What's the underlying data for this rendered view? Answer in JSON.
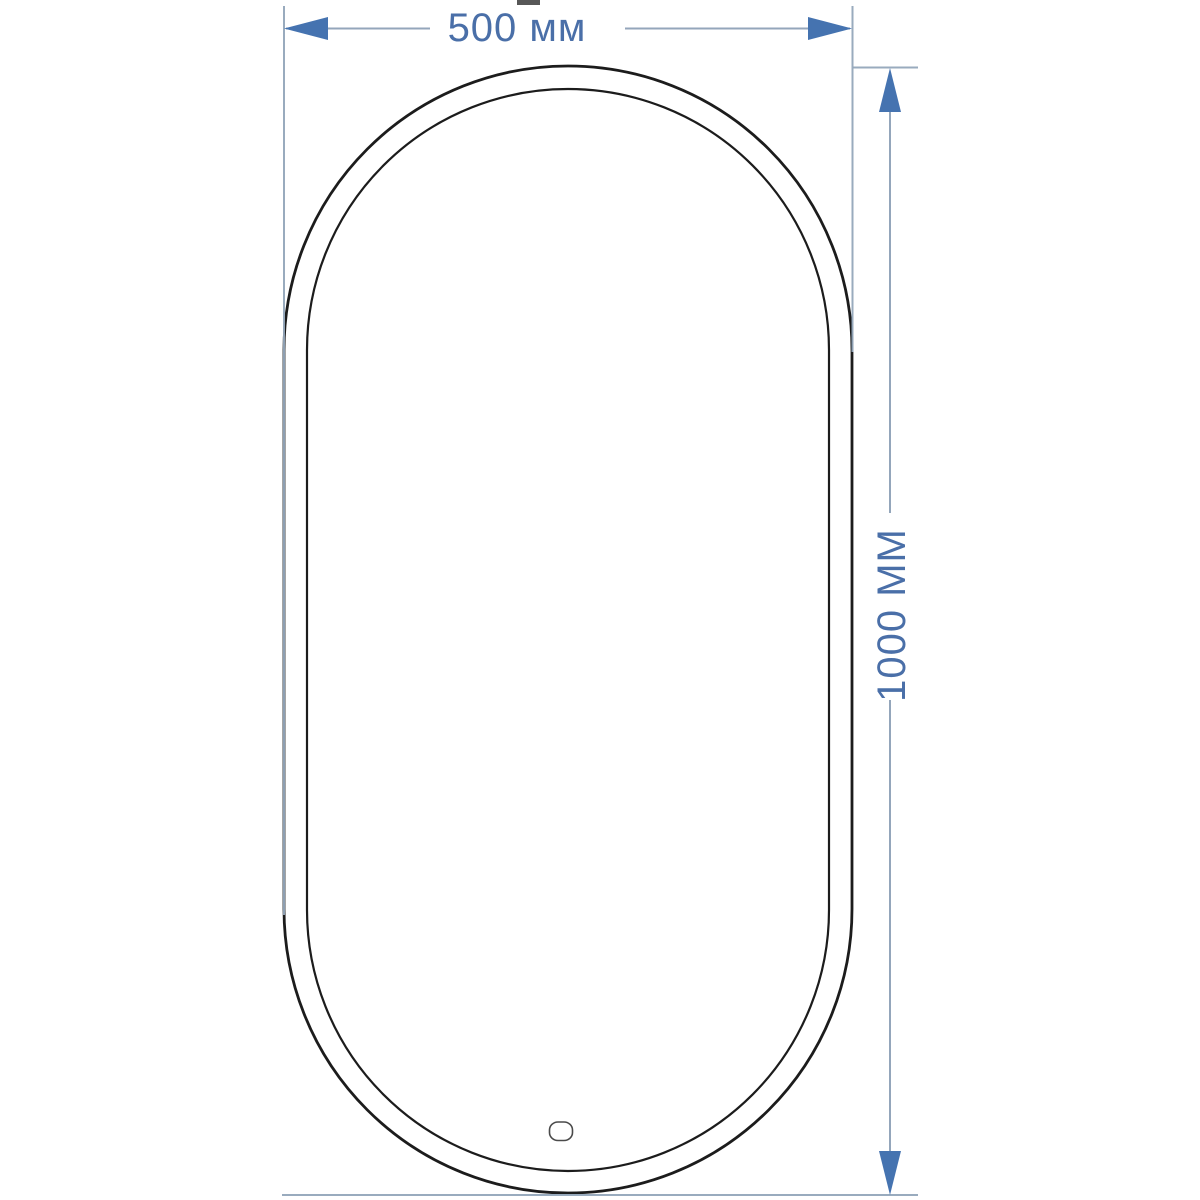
{
  "drawing": {
    "type": "technical-dimension-drawing",
    "subject": "oval stadium-shaped mirror, front view with touch sensor",
    "dimensions": {
      "width": {
        "value_mm": 500,
        "label": "500 мм"
      },
      "height": {
        "value_mm": 1000,
        "label": "1000 ММ"
      }
    },
    "colors": {
      "background": "#ffffff",
      "outline": "#1c1c1c",
      "dimension_line": "#94a6bb",
      "arrow_fill": "#4573b0",
      "label_text": "#4a6fa8",
      "sensor_outline": "#4a4a4a"
    },
    "geometry": {
      "outer_contour": {
        "x": 284,
        "y": 66,
        "width": 568,
        "height": 1127,
        "corner_radius": 284
      },
      "inner_contour": {
        "x": 307,
        "y": 89,
        "width": 522,
        "height": 1082,
        "corner_radius": 261
      },
      "sensor": {
        "cx": 561,
        "cy": 1131,
        "rx": 11.5,
        "ry": 9
      }
    }
  }
}
